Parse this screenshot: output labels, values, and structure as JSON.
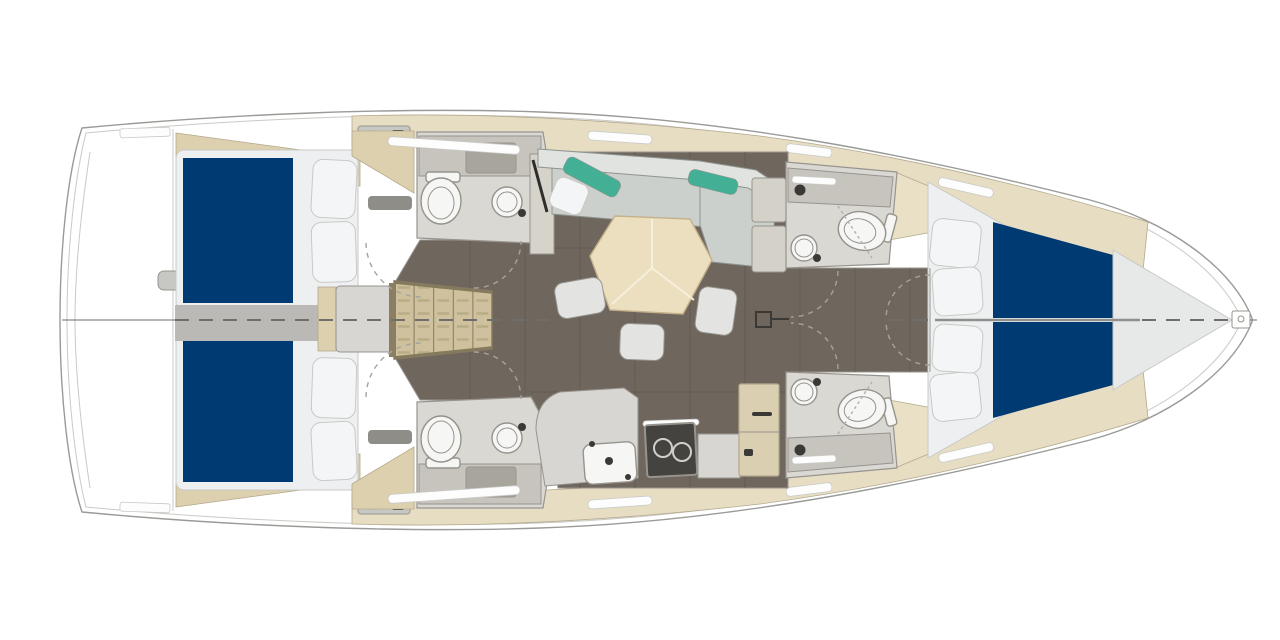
{
  "document": {
    "type": "sailing yacht interior floor plan",
    "view": "top-down deck plan",
    "orientation": {
      "bow": "right",
      "stern": "left"
    },
    "visible_text": []
  },
  "colors": {
    "background": "#ffffff",
    "hull_fill": "#ffffff",
    "hull_outline": "#9a9a97",
    "outline_light": "#c9c9c6",
    "outline_mid": "#97948e",
    "deck_band": "#e6ddc3",
    "deck_band_stroke": "#b3a98d",
    "floor_wood": "#6f675e",
    "floor_seam": "#5d564e",
    "aisle": "#bab9b6",
    "landing": "#d7d6d3",
    "wood_beige": "#ddd0ae",
    "stairs": "#cfc19d",
    "stairs_stroke": "#857a5e",
    "head_floor": "#dad8d3",
    "counter": "#c7c4bd",
    "sink_dark": "#a8a59d",
    "fixture": "#f6f6f4",
    "fixture_stroke": "#96938d",
    "dark_accent": "#3a3935",
    "mattress_blue": "#003a72",
    "mattress_white": "#edeff1",
    "pillow": "#f4f5f6",
    "sofa": "#ccd0cc",
    "sofa_light": "#e0e3e0",
    "sofa_stroke": "#8f948f",
    "teal": "#43b096",
    "table_top": "#ecdfc0",
    "table_stroke": "#c4b18a",
    "table_seam": "#f6efdd",
    "stool": "#e3e4e1",
    "stove": "#45433f",
    "burner": "#d0cfcb",
    "fridge": "#dbcfb2",
    "white_bar": "#fdfdfd",
    "dash": "#a3a3a0",
    "centerline": "#6e6e6b",
    "liner": "#e7e8e8",
    "transom_slot": "#c7c7c4"
  },
  "plan": {
    "rooms": [
      {
        "id": "stern-deck",
        "name": "Stern / transom platform",
        "furniture": [
          "transom step slot",
          "deck fittings"
        ]
      },
      {
        "id": "aft-cabin-port",
        "name": "Aft cabin — port",
        "furniture": [
          "double berth with navy mattress",
          "two pillows",
          "headboard shelf",
          "side locker"
        ]
      },
      {
        "id": "aft-cabin-starboard",
        "name": "Aft cabin — starboard",
        "furniture": [
          "double berth with navy mattress",
          "two pillows",
          "headboard shelf",
          "side locker"
        ]
      },
      {
        "id": "aft-head-port",
        "name": "Aft head — port",
        "furniture": [
          "toilet",
          "round washbasin",
          "vanity counter with sink",
          "towel bar"
        ]
      },
      {
        "id": "aft-head-starboard",
        "name": "Aft head — starboard",
        "furniture": [
          "toilet",
          "round washbasin",
          "vanity counter with sink",
          "towel bar"
        ]
      },
      {
        "id": "companionway",
        "name": "Companionway",
        "furniture": [
          "slatted stairs",
          "landing platform"
        ]
      },
      {
        "id": "salon",
        "name": "Salon",
        "furniture": [
          "L-shaped sofa",
          "two teal bolster cushions",
          "white throw pillow",
          "hexagonal dining table",
          "three stools",
          "sideboard",
          "mast post marker"
        ]
      },
      {
        "id": "galley",
        "name": "Galley",
        "furniture": [
          "L-shaped counter",
          "sink",
          "two-burner stove",
          "refrigerator cabinet"
        ]
      },
      {
        "id": "fwd-head-port",
        "name": "Forward head — port",
        "furniture": [
          "toilet",
          "round washbasin",
          "vanity counter",
          "shower partition"
        ]
      },
      {
        "id": "fwd-head-starboard",
        "name": "Forward head — starboard",
        "furniture": [
          "toilet",
          "round washbasin",
          "vanity counter",
          "shower partition"
        ]
      },
      {
        "id": "owner-cabin",
        "name": "Forward owner's cabin",
        "furniture": [
          "V-berth with split navy mattress",
          "four pillows"
        ]
      },
      {
        "id": "bow",
        "name": "Bow",
        "furniture": [
          "anchor fitting"
        ]
      }
    ],
    "centerline": "dashed fore-and-aft centerline at mid height"
  }
}
